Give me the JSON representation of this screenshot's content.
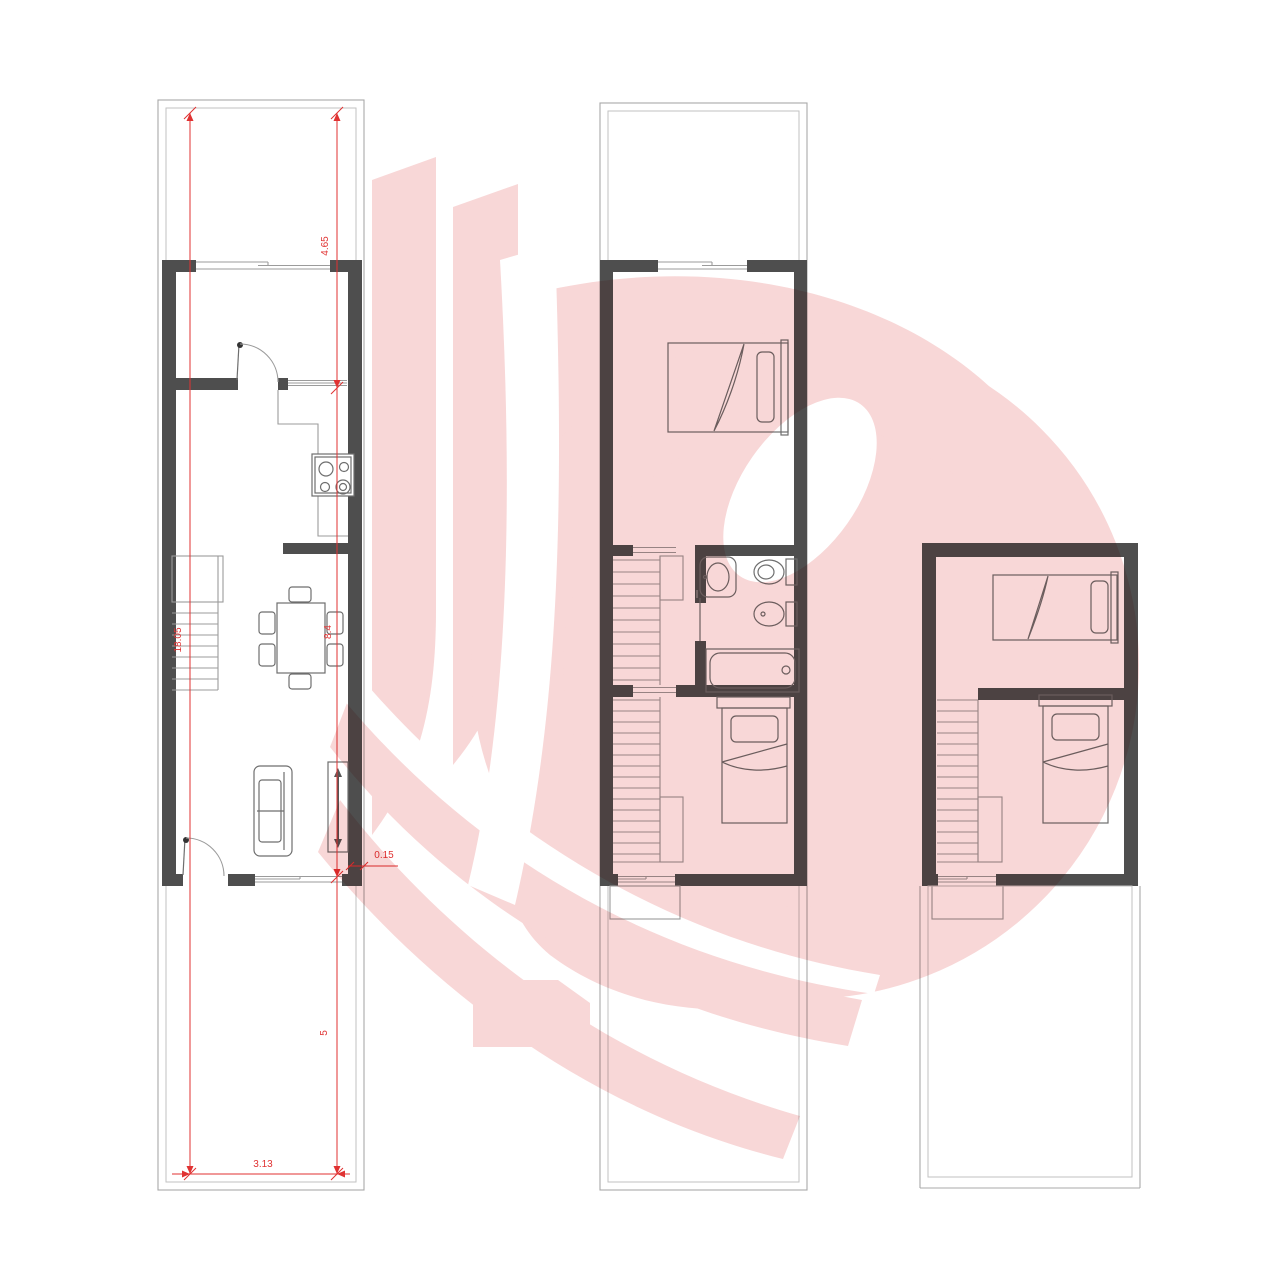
{
  "document": {
    "type": "architectural-floor-plans",
    "sheet_background": "#ffffff",
    "plans": [
      "ground-floor",
      "first-floor",
      "second-floor"
    ]
  },
  "colors": {
    "wall": "#4e4e4e",
    "thin_line": "#9b9b9b",
    "furniture_line": "#6e6e6e",
    "dimension_red": "#e03232",
    "watermark_pink": "#f8d7d7"
  },
  "watermark": {
    "shape": "stylized-letter-D-flame-logo",
    "color": "#f8d7d7"
  },
  "ground_floor": {
    "dimensions": {
      "front_setback": "4.65",
      "house_depth": "8.4",
      "rear_yard": "5",
      "total_depth": "18.05",
      "interior_width": "3.13",
      "wall_thickness": "0.15"
    },
    "furniture": [
      "sliding-window",
      "interior-door",
      "entry-door",
      "kitchen-counter",
      "stove",
      "stairs",
      "dining-table",
      "chairs",
      "sofa",
      "sideboard"
    ]
  },
  "first_floor": {
    "furniture": [
      "double-bed",
      "single-bed",
      "stairs",
      "sink",
      "toilet",
      "bidet",
      "bathtub",
      "bathroom-door",
      "step"
    ]
  },
  "second_floor": {
    "furniture": [
      "single-bed",
      "single-bed",
      "stairs",
      "step"
    ]
  }
}
